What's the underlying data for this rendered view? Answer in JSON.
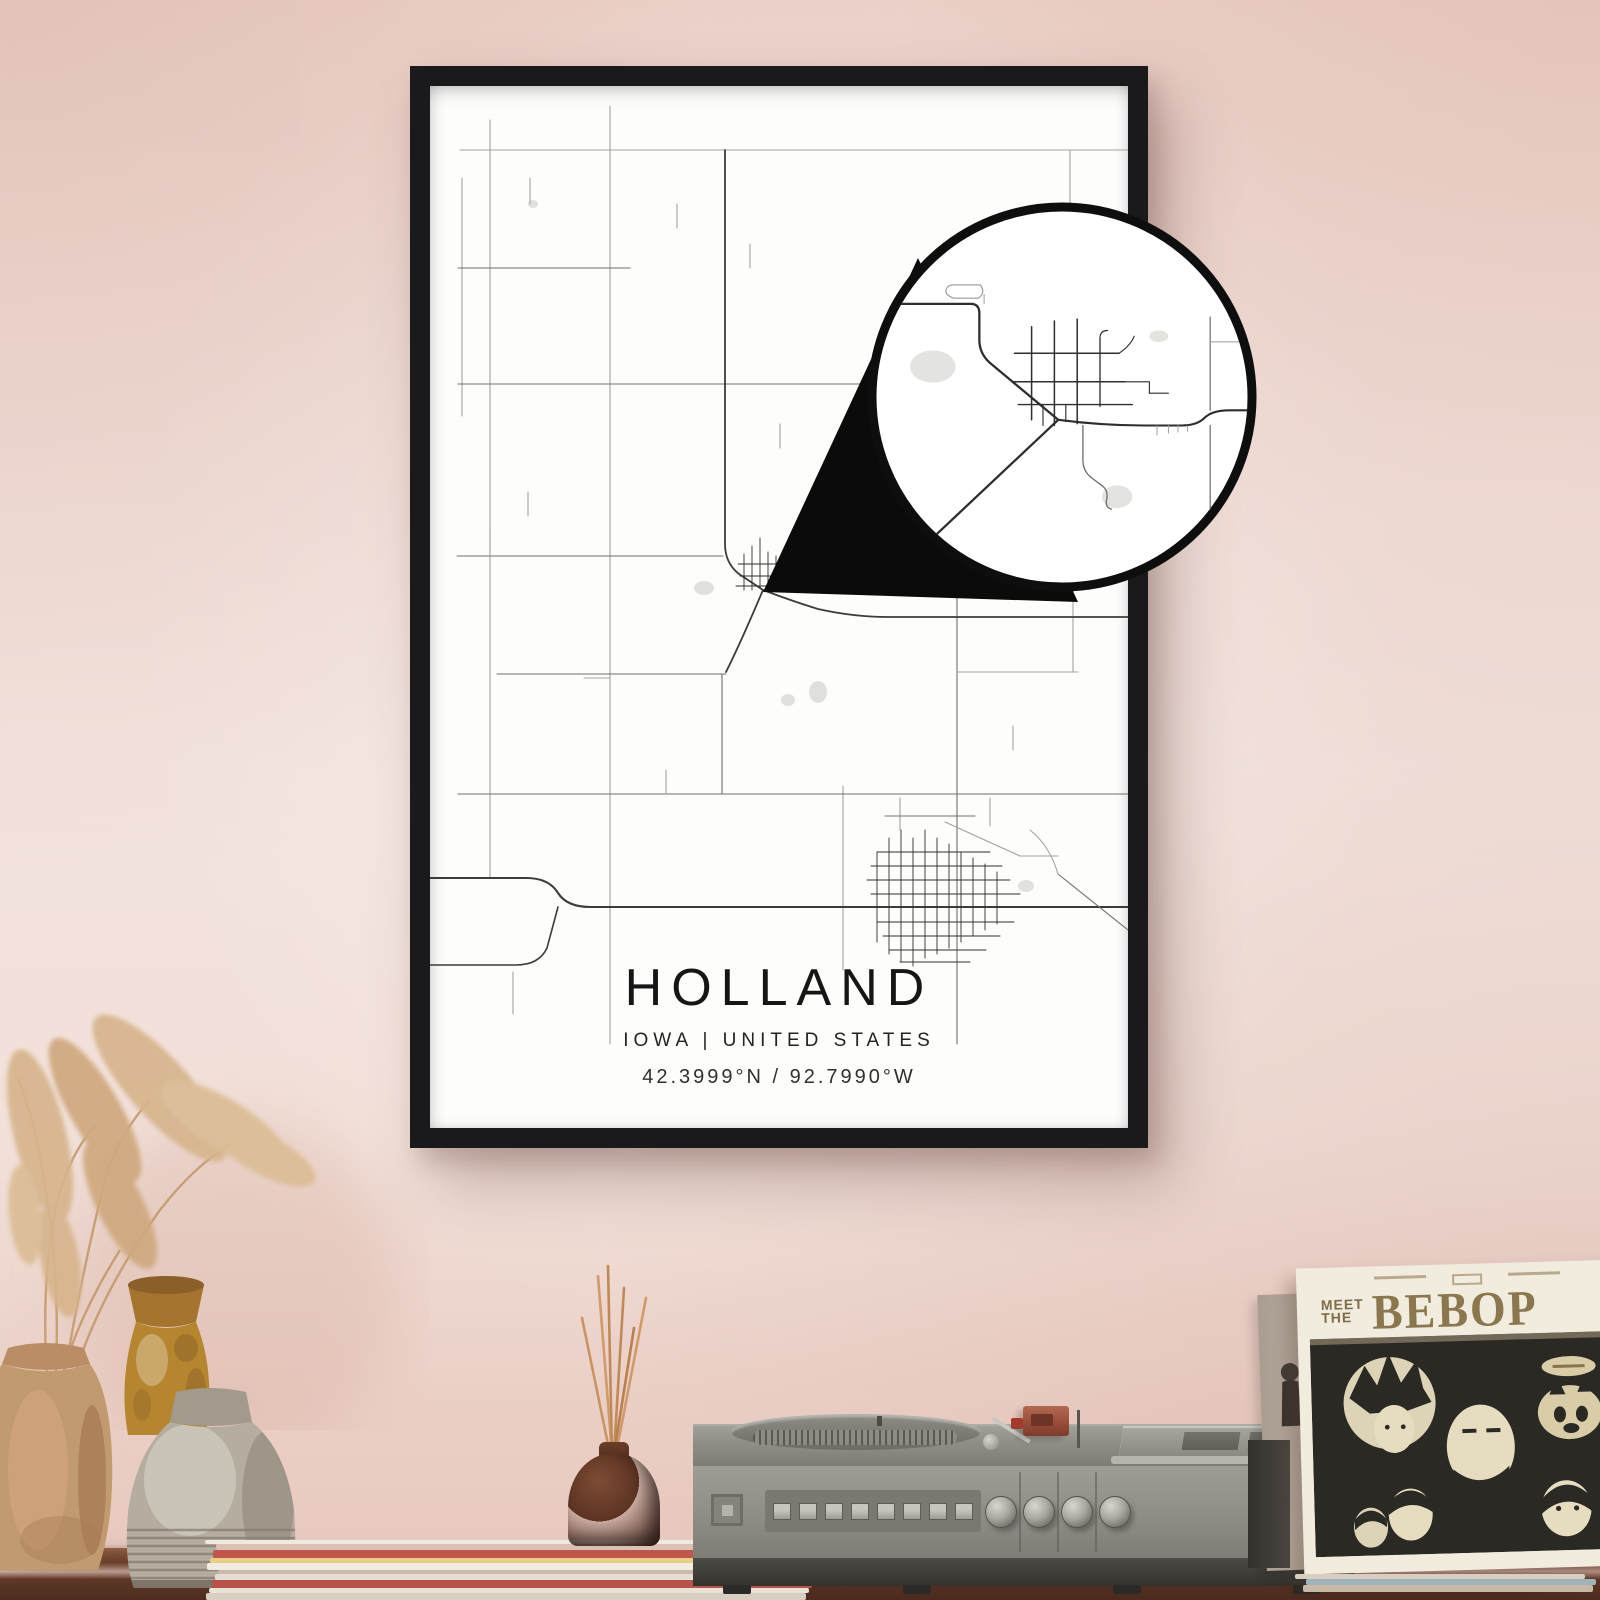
{
  "poster": {
    "title": "HOLLAND",
    "subtitle": "IOWA | UNITED STATES",
    "coordinates": "42.3999°N / 92.7990°W",
    "frame_color": "#1a1a1c",
    "paper_color": "#ffffff"
  },
  "record_sleeve": {
    "pretitle_line1": "MEET",
    "pretitle_line2": "THE",
    "title": "BEBOP"
  },
  "record_player": {
    "button_count": 8,
    "knob_count": 4,
    "body_color": "#8d8c84"
  },
  "magazine_stack": {
    "colors": [
      "#efe9df",
      "#d9c2b4",
      "#c0564e",
      "#e6d084",
      "#f1ebe1",
      "#cdb9a9",
      "#e3ded4",
      "#b8534b",
      "#e9e2d6",
      "#d8cfc2"
    ]
  },
  "record_pile": {
    "colors": [
      "#d8cfc0",
      "#9fb4ba",
      "#c8b8a6"
    ]
  },
  "scene_colors": {
    "wall": "#f1ddd6",
    "shelf": "#5f3826",
    "accent_terracotta": "#c29a6f",
    "accent_amber": "#b5862f",
    "accent_stone": "#b5ada0"
  },
  "map": {
    "colors": {
      "minor": "#a2a29e",
      "mid": "#6f6f6b",
      "major": "#3c3c3a",
      "town": "#2f2f2d",
      "water": "#e0e0dc"
    },
    "ponds": [
      {
        "cx": 274,
        "cy": 502,
        "rx": 10,
        "ry": 7
      },
      {
        "cx": 358,
        "cy": 614,
        "rx": 7,
        "ry": 6
      },
      {
        "cx": 388,
        "cy": 606,
        "rx": 9,
        "ry": 11
      },
      {
        "cx": 103,
        "cy": 118,
        "rx": 5,
        "ry": 4
      },
      {
        "cx": 596,
        "cy": 800,
        "rx": 8,
        "ry": 6
      }
    ],
    "roads": [
      {
        "d": "M30,64 H698",
        "c": "minor"
      },
      {
        "d": "M32,92 V330",
        "c": "minor"
      },
      {
        "d": "M60,34 V792",
        "c": "minor"
      },
      {
        "d": "M180,20 V958",
        "c": "minor"
      },
      {
        "d": "M28,182 H200",
        "c": "mid"
      },
      {
        "d": "M527,254 H698",
        "c": "minor"
      },
      {
        "d": "M640,64 V254",
        "c": "minor"
      },
      {
        "d": "M28,298 H662",
        "c": "mid"
      },
      {
        "d": "M27,470 H293",
        "c": "mid"
      },
      {
        "d": "M67,588 H296",
        "c": "mid"
      },
      {
        "d": "M292,588 V708",
        "c": "mid"
      },
      {
        "d": "M413,700 V884",
        "c": "minor"
      },
      {
        "d": "M527,508 V958",
        "c": "mid"
      },
      {
        "d": "M643,468 V586",
        "c": "minor"
      },
      {
        "d": "M527,586 H648",
        "c": "minor"
      },
      {
        "d": "M28,708 H698",
        "c": "mid"
      },
      {
        "d": "M100,92 V118",
        "c": "minor"
      },
      {
        "d": "M247,118 V142",
        "c": "minor"
      },
      {
        "d": "M98,406 V430",
        "c": "minor"
      },
      {
        "d": "M350,338 V362",
        "c": "minor"
      },
      {
        "d": "M460,238 V262",
        "c": "minor"
      },
      {
        "d": "M583,640 V664",
        "c": "minor"
      },
      {
        "d": "M60,446 V470",
        "c": "minor"
      },
      {
        "d": "M154,592 H180",
        "c": "minor"
      },
      {
        "d": "M236,684 V708",
        "c": "minor"
      },
      {
        "d": "M320,158 V182",
        "c": "minor"
      },
      {
        "d": "M295,64 V458 Q295,477 309,488 L333,504",
        "c": "major",
        "w": 1.8
      },
      {
        "d": "M333,504 Q311,556 296,586",
        "c": "major",
        "w": 1.8
      },
      {
        "d": "M333,504 Q362,515 388,523 Q424,531 458,531 H698",
        "c": "major",
        "w": 1.8
      },
      {
        "d": "M0,792 H96 Q119,792 128,807 Q137,821 160,821 H698",
        "c": "major",
        "w": 2.1
      },
      {
        "d": "M0,879 H86 Q109,879 117,862 L128,821",
        "c": "major",
        "w": 1.6
      },
      {
        "d": "M628,788 L698,844",
        "c": "mid"
      },
      {
        "d": "M83,886 V928",
        "c": "minor"
      },
      {
        "d": "M314,468 V504",
        "c": "town",
        "w": 0.9
      },
      {
        "d": "M322,460 V504",
        "c": "town",
        "w": 0.9
      },
      {
        "d": "M330,452 V502",
        "c": "town",
        "w": 0.9
      },
      {
        "d": "M338,466 V500",
        "c": "town",
        "w": 0.9
      },
      {
        "d": "M346,470 V500",
        "c": "town",
        "w": 0.9
      },
      {
        "d": "M308,478 H354",
        "c": "town",
        "w": 0.9
      },
      {
        "d": "M310,490 H358",
        "c": "town",
        "w": 0.9
      },
      {
        "d": "M306,500 H362",
        "c": "town",
        "w": 0.9
      },
      {
        "d": "M354,486 H370",
        "c": "town",
        "w": 0.9
      },
      {
        "d": "M352,470 H362",
        "c": "town",
        "w": 0.9
      },
      {
        "d": "M447,766 V856",
        "c": "town",
        "w": 0.9
      },
      {
        "d": "M459,752 V868",
        "c": "town",
        "w": 0.9
      },
      {
        "d": "M471,744 V876",
        "c": "town",
        "w": 0.9
      },
      {
        "d": "M483,752 V880",
        "c": "town",
        "w": 0.9
      },
      {
        "d": "M495,744 V872",
        "c": "town",
        "w": 0.9
      },
      {
        "d": "M507,752 V868",
        "c": "town",
        "w": 0.9
      },
      {
        "d": "M519,758 V862",
        "c": "town",
        "w": 0.9
      },
      {
        "d": "M531,766 V856",
        "c": "town",
        "w": 0.9
      },
      {
        "d": "M543,772 V850",
        "c": "town",
        "w": 0.9
      },
      {
        "d": "M555,778 V844",
        "c": "town",
        "w": 0.9
      },
      {
        "d": "M567,786 V838",
        "c": "town",
        "w": 0.9
      },
      {
        "d": "M447,766 H560",
        "c": "town",
        "w": 0.9
      },
      {
        "d": "M441,780 H572",
        "c": "town",
        "w": 0.9
      },
      {
        "d": "M437,794 H580",
        "c": "town",
        "w": 0.9
      },
      {
        "d": "M441,808 H590",
        "c": "town",
        "w": 0.9
      },
      {
        "d": "M447,836 H584",
        "c": "town",
        "w": 0.9
      },
      {
        "d": "M453,850 H570",
        "c": "town",
        "w": 0.9
      },
      {
        "d": "M459,864 H556",
        "c": "town",
        "w": 0.9
      },
      {
        "d": "M470,876 H540",
        "c": "town",
        "w": 0.9
      },
      {
        "d": "M470,712 V744",
        "c": "minor"
      },
      {
        "d": "M455,730 H545",
        "c": "mid"
      },
      {
        "d": "M515,736 L590,770",
        "c": "minor"
      },
      {
        "d": "M590,770 H628",
        "c": "minor"
      },
      {
        "d": "M560,712 V740",
        "c": "minor"
      },
      {
        "d": "M600,744 Q620,760 628,788",
        "c": "minor"
      }
    ]
  },
  "callout": {
    "ring_color": "#0e0e0e",
    "colors": {
      "minor": "#9a9a96",
      "mid": "#6f6f6b",
      "major": "#2e2e2c",
      "town": "#2f2f2d",
      "water": "#e3e3df"
    },
    "ponds": [
      {
        "cx": 64,
        "cy": 168,
        "rx": 24,
        "ry": 17
      },
      {
        "cx": 258,
        "cy": 305,
        "rx": 16,
        "ry": 12
      },
      {
        "cx": 302,
        "cy": 136,
        "rx": 10,
        "ry": 6
      }
    ],
    "roads": [
      {
        "d": "M0,102 H104 Q113,102 113,112 V140 Q113,154 124,164 L196,224",
        "c": "major",
        "w": 2.4
      },
      {
        "d": "M196,224 L60,352",
        "c": "major",
        "w": 2.4
      },
      {
        "d": "M196,224 Q242,230 286,230 H326 Q342,230 350,222 Q358,214 376,214 H400",
        "c": "major",
        "w": 2.2
      },
      {
        "d": "M84,82 h30 q6,8 -2,14 h-26 q-10,-4 -8,-9 q1,-4 6,-5 z",
        "c": "minor",
        "w": 1.2
      },
      {
        "d": "M222,230 V266 Q222,278 231,285 L243,294 Q249,299 247,308 Q245,316 252,318",
        "c": "mid",
        "w": 1.4
      },
      {
        "d": "M168,126 V224",
        "c": "town",
        "w": 1.6
      },
      {
        "d": "M192,120 V230",
        "c": "town",
        "w": 1.6
      },
      {
        "d": "M216,118 V228",
        "c": "town",
        "w": 1.6
      },
      {
        "d": "M240,138 V210",
        "c": "town",
        "w": 1.4
      },
      {
        "d": "M240,138 Q240,130 248,130",
        "c": "town",
        "w": 1.2
      },
      {
        "d": "M150,154 H260",
        "c": "town",
        "w": 1.6
      },
      {
        "d": "M148,184 H266",
        "c": "town",
        "w": 1.6
      },
      {
        "d": "M154,208 H274",
        "c": "town",
        "w": 1.4
      },
      {
        "d": "M260,154 Q272,146 276,136",
        "c": "town",
        "w": 1.2
      },
      {
        "d": "M266,184 H292 V196",
        "c": "town",
        "w": 1.2
      },
      {
        "d": "M180,208 V230",
        "c": "town",
        "w": 1.2
      },
      {
        "d": "M204,208 V226",
        "c": "town",
        "w": 1.2
      },
      {
        "d": "M292,196 H312",
        "c": "town",
        "w": 1.2
      },
      {
        "d": "M300,230 V240",
        "c": "minor",
        "w": 1
      },
      {
        "d": "M312,230 V238",
        "c": "minor",
        "w": 1
      },
      {
        "d": "M322,230 V237",
        "c": "minor",
        "w": 1
      },
      {
        "d": "M332,230 V236",
        "c": "minor",
        "w": 1
      },
      {
        "d": "M356,116 V214",
        "c": "mid",
        "w": 1.3
      },
      {
        "d": "M356,230 V320",
        "c": "mid",
        "w": 1.3
      },
      {
        "d": "M356,142 H386",
        "c": "minor",
        "w": 1
      },
      {
        "d": "M118,92 V102",
        "c": "minor",
        "w": 1
      }
    ]
  }
}
